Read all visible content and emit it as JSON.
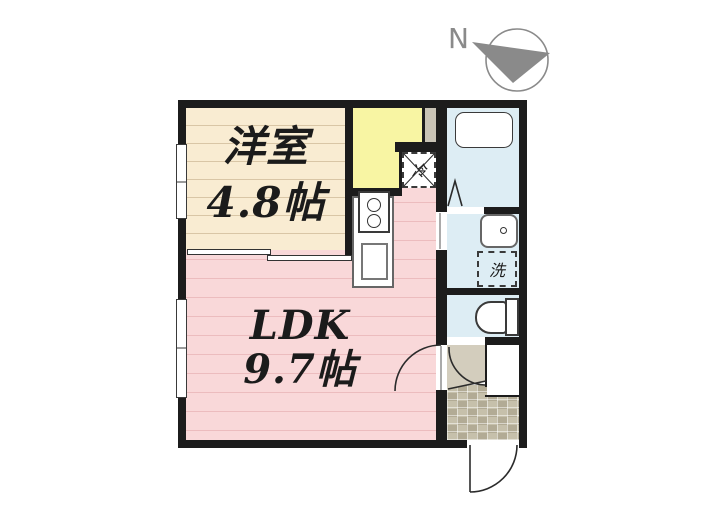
{
  "title": "apartment-floor-plan",
  "compass": {
    "label": "N"
  },
  "rooms": {
    "yoshitsu": {
      "name": "洋室",
      "size": "4.8帖"
    },
    "ldk": {
      "name": "LDK",
      "size": "9.7帖"
    }
  },
  "fixtures": {
    "refrigerator": "冷",
    "washer": "洗"
  },
  "colors": {
    "wall": "#1c1c1c",
    "line": "#2b2b2b",
    "cream": "#f9ecd2",
    "creamStripe": "#d9c6a6",
    "pink": "#f9d8d9",
    "pinkStripe": "#ecbcbe",
    "yellow": "#f8f5a3",
    "water": "#ddedf4",
    "hall": "#d3cdbd",
    "tile": "#c6c0ab",
    "tileDark": "#b2ab95",
    "ps": "#c9c4b6",
    "compass": "#8a8a8a",
    "text": "#1b1b1b",
    "fixtureBorder": "#3a3a3a"
  }
}
